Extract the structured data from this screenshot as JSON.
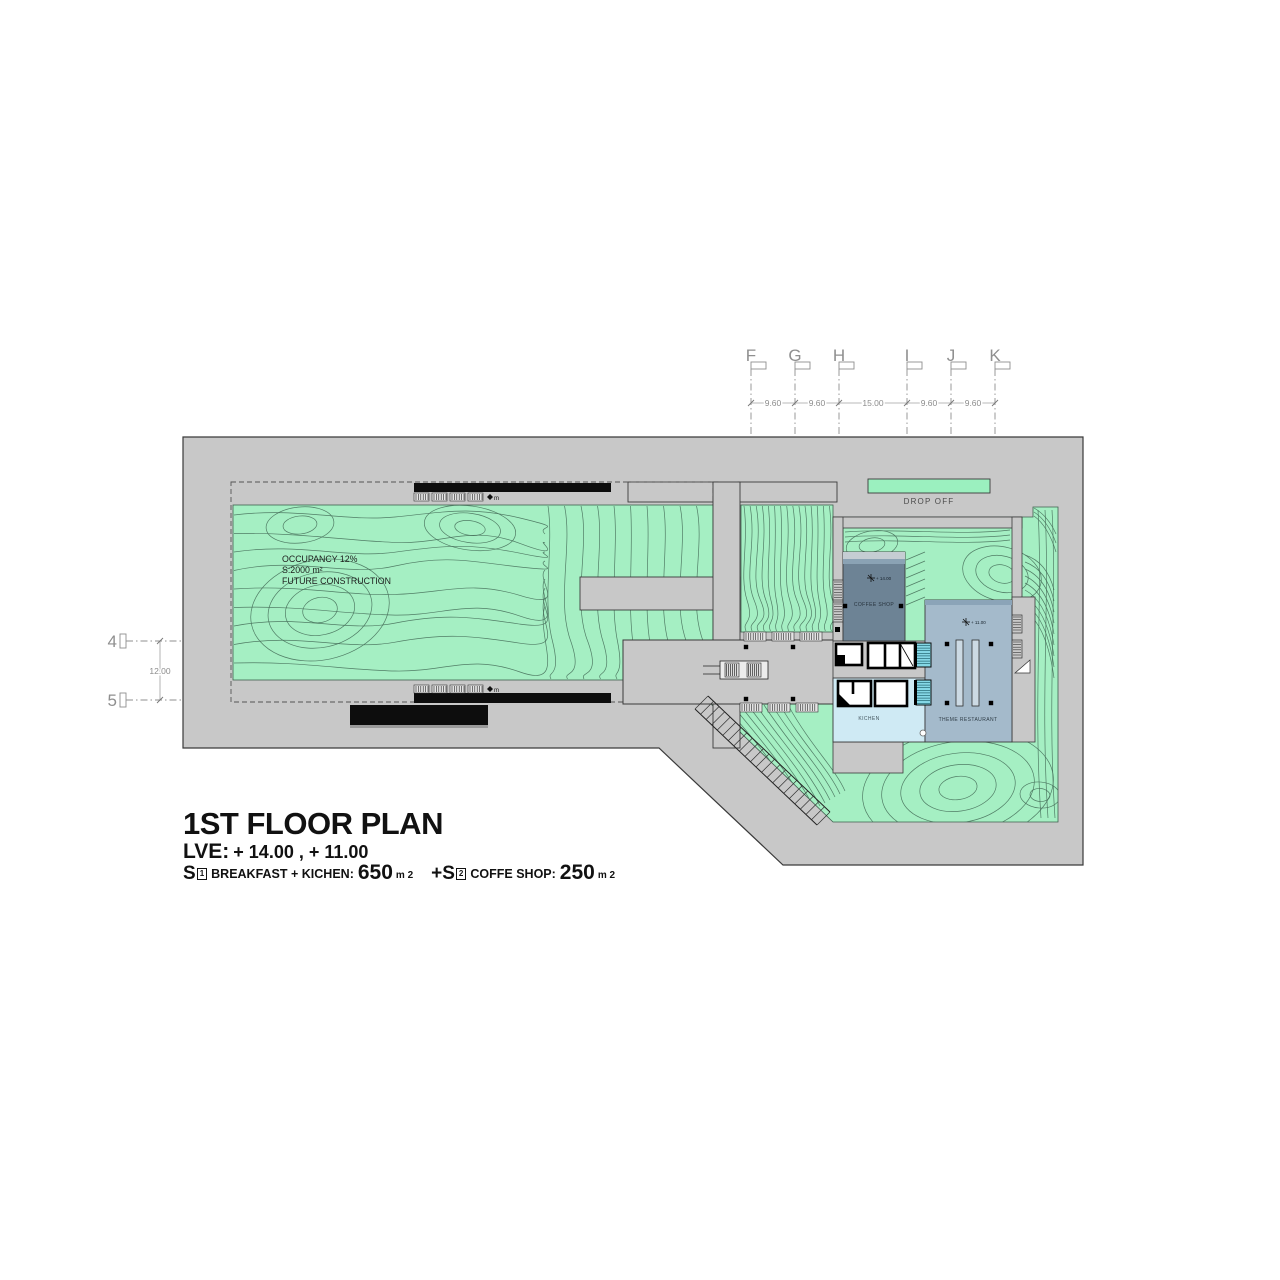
{
  "title_block": {
    "title": "1ST  FLOOR PLAN",
    "level_label": "LVE:",
    "level_value": "+ 14.00 , + 11.00",
    "legend": {
      "s1_prefix": "S",
      "s1_box": "1",
      "s1_label": "BREAKFAST + KICHEN:",
      "s1_value": "650",
      "s1_unit": "m 2",
      "s2_prefix": "+S",
      "s2_box": "2",
      "s2_label": "COFFE SHOP:",
      "s2_value": "250",
      "s2_unit": "m 2"
    }
  },
  "grid": {
    "columns": [
      {
        "label": "F"
      },
      {
        "label": "G"
      },
      {
        "label": "H"
      },
      {
        "label": "I"
      },
      {
        "label": "J"
      },
      {
        "label": "K"
      }
    ],
    "col_dims": [
      "9.60",
      "9.60",
      "15.00",
      "9.60",
      "9.60"
    ],
    "rows": [
      {
        "label": "4"
      },
      {
        "label": "5"
      }
    ],
    "row_dim": "12.00"
  },
  "annotations": {
    "occupancy": "OCCUPANCY 12%",
    "area": "S:2000 m²",
    "future": "FUTURE CONSTRUCTION",
    "drop_off": "DROP OFF",
    "louver_marker": "m"
  },
  "rooms": {
    "coffee_shop": {
      "label": "COFFEE SHOP",
      "level": "+ 14.00"
    },
    "theme_restaurant": {
      "label": "THEME RESTAURANT",
      "level": "+ 11.00"
    },
    "kitchen": {
      "label": "KICHEN"
    }
  },
  "colors": {
    "site": "#c8c8c8",
    "outline": "#3a3a3a",
    "green": "#a5efc3",
    "dropoff_green": "#9bf0bf",
    "contour": "#47705b",
    "coffee": "#6d8395",
    "coffee_band": "#8aa2b4",
    "coffee_top": "#c5cdd3",
    "restaurant": "#a4bacb",
    "restaurant_band": "#8ba4b8",
    "kitchen": "#cfeaf4",
    "stair_cyan": "#84d7e5",
    "black": "#0d0d0d",
    "grid_gray": "#8f8f8f",
    "dim_gray": "#999999"
  }
}
